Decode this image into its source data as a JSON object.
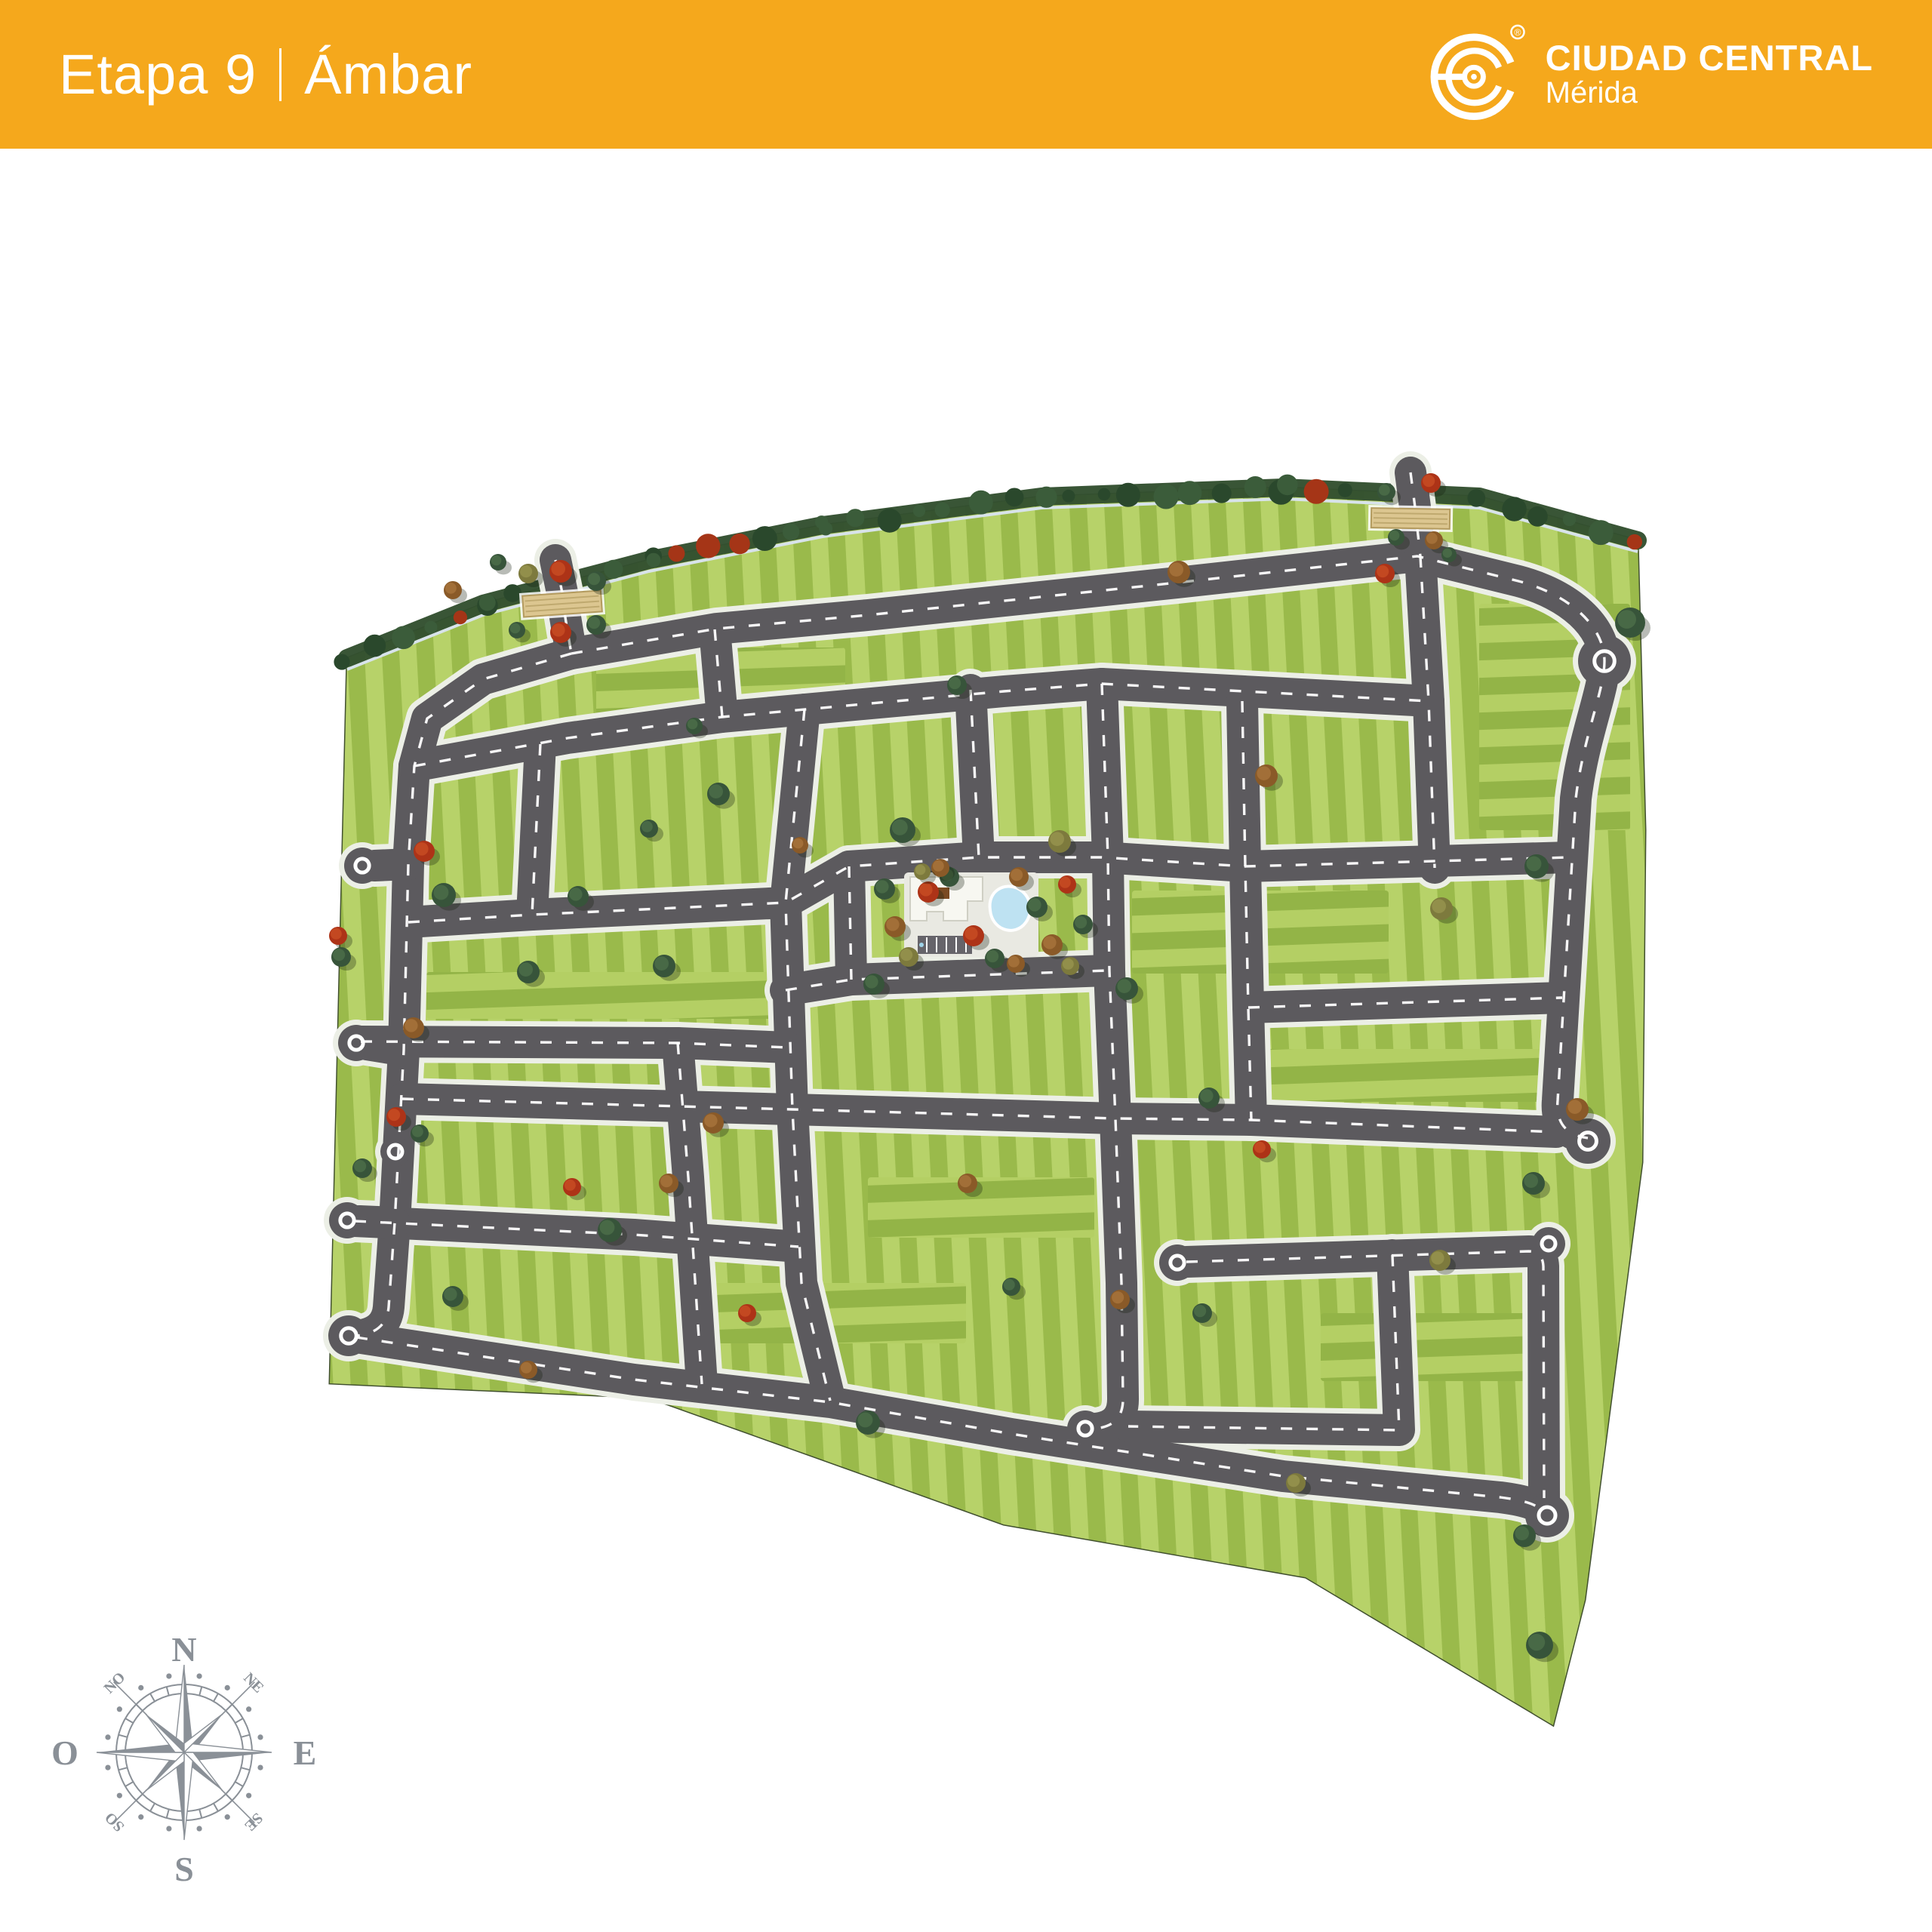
{
  "header": {
    "title": {
      "stage": "Etapa 9",
      "divider": "|",
      "name": "Ámbar"
    },
    "logo": {
      "brand": "CIUDAD CENTRAL",
      "city": "Mérida",
      "registered": "®"
    }
  },
  "compass": {
    "cardinals": {
      "n": "N",
      "e": "E",
      "s": "S",
      "w": "O"
    },
    "intercardinals": {
      "nw": "NO",
      "ne": "NE",
      "sw": "SO",
      "se": "SE"
    }
  },
  "colors": {
    "header_bg": "#F5A81C",
    "road": "#5C5A5E",
    "sidewalk": "#ECEFE6",
    "lot_light": "#B7D269",
    "lot_dark": "#9ABA4B",
    "hedge": "#33502F",
    "pool": "#BEE2F2",
    "gate": "#DCC690",
    "compass": "#8A9097"
  }
}
